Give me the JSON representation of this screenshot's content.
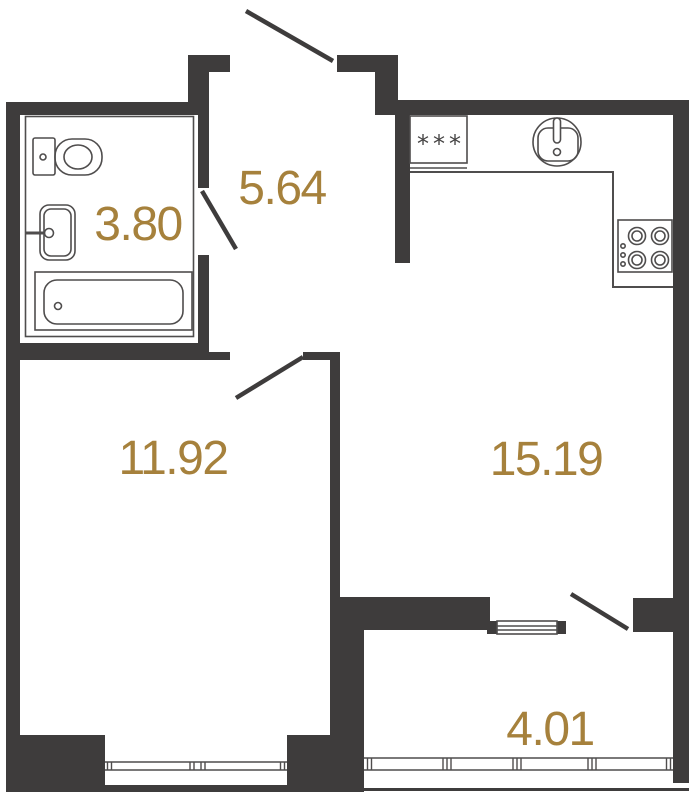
{
  "plan": {
    "type": "apartment-floor-plan",
    "rooms": [
      {
        "id": "bathroom",
        "area": "3.80"
      },
      {
        "id": "hallway",
        "area": "5.64"
      },
      {
        "id": "living-room",
        "area": "11.92"
      },
      {
        "id": "kitchen-living-room",
        "area": "15.19"
      },
      {
        "id": "balcony",
        "area": "4.01"
      }
    ],
    "fixtures": [
      "toilet",
      "wash-basin",
      "bathtub",
      "refrigerator",
      "kitchen-sink",
      "cooktop-4-burners",
      "entrance-door",
      "bathroom-door",
      "living-room-door",
      "balcony-door",
      "living-room-window",
      "balcony-glazing",
      "balcony-window"
    ],
    "symbols": {
      "refrigerator": "***"
    },
    "colors": {
      "wall": "#3e3c3c",
      "area_label": "#a6813c",
      "fixture_line": "#4f4d4d",
      "background": "#ffffff"
    }
  }
}
